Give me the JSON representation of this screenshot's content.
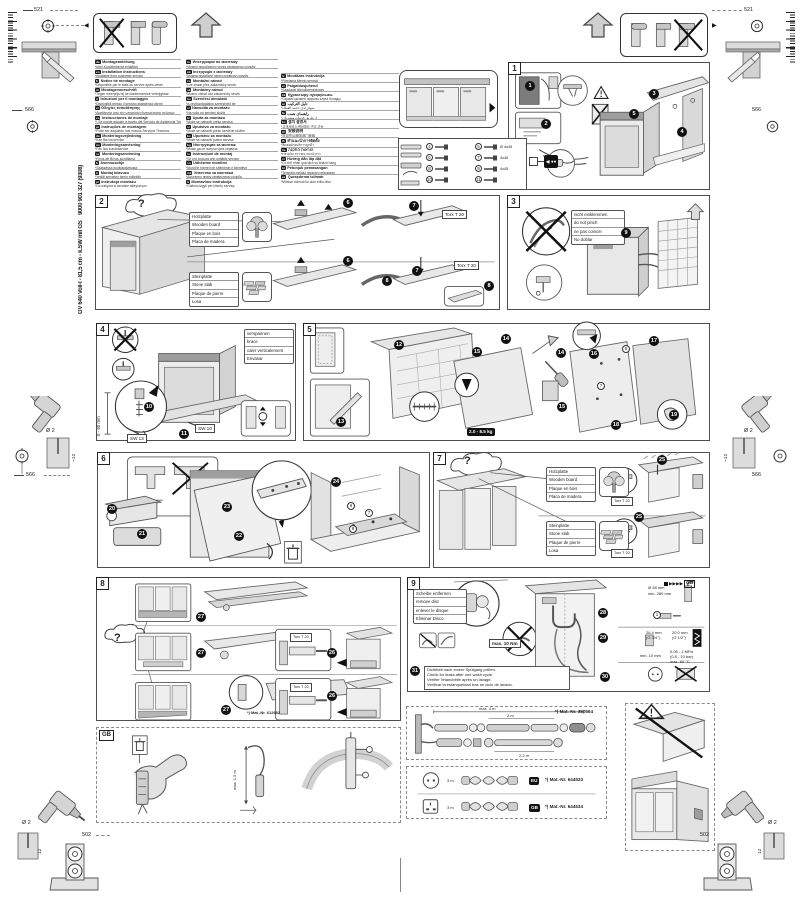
{
  "doc": {
    "model": "GV 640 Voll-I - 81,5 cm - k.SW mit GS",
    "order_no": "9000 901 327 (9308)"
  },
  "glyphs": {
    "question": "?",
    "tri_left": "◀",
    "tri_right": "▶",
    "fwd_arrows": "▶▶▶▶",
    "back_arrow": "◀"
  },
  "corner_dims": {
    "width_521": "521",
    "depth_566": "566",
    "offset_502": "502",
    "hole_dia": "Ø 2",
    "hole_depth": "12",
    "hole_depth_tilde": "~12"
  },
  "labels": {
    "wood": [
      "Holzplatte",
      "Wooden board",
      "Plaque en bois",
      "Placa de madera"
    ],
    "stone": [
      "Steinplatte",
      "Stone slab",
      "Plaque de pierre",
      "Losa"
    ],
    "torx": "Torx T 20"
  },
  "languages": {
    "col1": [
      {
        "code": "de",
        "title": "Montageanleitung",
        "note": "*über Kundendienst erhältlich"
      },
      {
        "code": "en",
        "title": "Installation instructions",
        "note": "*Available from customer service"
      },
      {
        "code": "fr",
        "title": "Notice de montage",
        "note": "*Disponible par le biais du service après-vente"
      },
      {
        "code": "nl",
        "title": "Montagevoorschrift",
        "note": "*Tegen meerprijs bij de klantenservice verkrijgbaar"
      },
      {
        "code": "it",
        "title": "Istruzioni per il montaggio",
        "note": "*Disponibili presso il servizio assistenza clienti"
      },
      {
        "code": "el",
        "title": "Οδηγίες τοποθέτησης",
        "note": "*Διατίθενται από την υπηρεσία εξυπηρέτησης πελατών"
      },
      {
        "code": "es",
        "title": "Instrucciones de montaje",
        "note": "*) Se puede adquirir a través del Servicio de Asistencia Técnica"
      },
      {
        "code": "pt",
        "title": "Instruções de montagem",
        "note": "*Pode ser adquirido nos nossos Serviços Técnicos"
      },
      {
        "code": "da",
        "title": "Monteringsvejledning",
        "note": "*Kan fås via service"
      },
      {
        "code": "no",
        "title": "Monteringsanvisning",
        "note": "*Fås hos kundeservice"
      },
      {
        "code": "sv",
        "title": "Monteringsanvisning",
        "note": "*Finns att få hos kundtjänst"
      },
      {
        "code": "fi",
        "title": "Asennusohje",
        "note": "*Saatavissa huoltopalvelusta"
      },
      {
        "code": "tr",
        "title": "Montaj kılavuzu",
        "note": "*Yetkili servisten temin edilebilir"
      },
      {
        "code": "pl",
        "title": "Instrukcja montażu",
        "note": "*Do nabycia w serwisie fabrycznym"
      }
    ],
    "col2": [
      {
        "code": "ru",
        "title": "Инструкция по монтажу",
        "note": "*Можно приобрести через сервисную службу"
      },
      {
        "code": "uk",
        "title": "Інструкція з монтажу",
        "note": "*Можна придбати через сервісну службу"
      },
      {
        "code": "cs",
        "title": "Montážní návod",
        "note": "*Lze získat přes zákaznický servis"
      },
      {
        "code": "sk",
        "title": "Montážny návod",
        "note": "*Možno získať cez zákaznícky servis"
      },
      {
        "code": "hu",
        "title": "Szerelési útmutató",
        "note": "*A vevőszolgálaton szerezhető be"
      },
      {
        "code": "sl",
        "title": "Navodila za montažo",
        "note": "*Na voljo pri servisni službi"
      },
      {
        "code": "hr",
        "title": "Uputa za montažu",
        "note": "*Može se nabaviti preko servisa"
      },
      {
        "code": "sr",
        "title": "Uputstvo za montažu",
        "note": "*Može se nabaviti preko servisne službe"
      },
      {
        "code": "bs",
        "title": "Uputstvo za montažu",
        "note": "*Može se nabaviti putem servisa"
      },
      {
        "code": "bg",
        "title": "Инструкция за монтаж",
        "note": "*Може да се получи чрез сервиза"
      },
      {
        "code": "ro",
        "title": "Instrucţiuni de montaj",
        "note": "*Se pot procura prin unităţile service"
      },
      {
        "code": "sq",
        "title": "Udhëzime montimi",
        "note": "*Mund të merren në shërbimin e klientëve"
      },
      {
        "code": "mk",
        "title": "Упатство за монтажа",
        "note": "*Достапно преку сервисната служба"
      },
      {
        "code": "lt",
        "title": "Montavimo instrukcija",
        "note": "*Galima įsigyti per klientų servisą"
      }
    ],
    "col3": [
      {
        "code": "lv",
        "title": "Montāžas instrukcija",
        "note": "*Pieejama klientu servisā"
      },
      {
        "code": "et",
        "title": "Paigaldusjuhend",
        "note": "*Saadaval klienditeeninduses"
      },
      {
        "code": "kk",
        "title": "Құрастыру нұсқаулығы",
        "note": "*Сервис қызметі арқылы алуға болады"
      },
      {
        "code": "ar",
        "title": "دليل التركيب",
        "note": "*متوفر لدى خدمة العملاء"
      },
      {
        "code": "fa",
        "title": "راهنمای نصب",
        "note": "*از طریق خدمات مشتریان"
      },
      {
        "code": "ko",
        "title": "설치 설명서",
        "note": "*고객서비스센터에서 구입 가능"
      },
      {
        "code": "zh",
        "title": "安装说明",
        "note": "*可向售后服务部门索取"
      },
      {
        "code": "th",
        "title": "คำแนะนำการติดตั้ง",
        "note": "*ติดต่อฝ่ายบริการลูกค้า"
      },
      {
        "code": "he",
        "title": "הוראות התקנה",
        "note": "*ניתן להשיג בשירות הלקוחות"
      },
      {
        "code": "vi",
        "title": "Hướng dẫn lắp đặt",
        "note": "*Có thể nhận qua dịch vụ khách hàng"
      },
      {
        "code": "id",
        "title": "Petunjuk pemasangan",
        "note": "*Tersedia melalui layanan pelanggan"
      },
      {
        "code": "az",
        "title": "Quraşdırma təlimatı",
        "note": "*Müştəri xidməti ilə əldə edilə bilər"
      }
    ]
  },
  "panel1": {
    "no": "1",
    "markers": [
      "1",
      "2",
      "3",
      "4",
      "5"
    ],
    "parts": [
      {
        "n": "4",
        "size": ""
      },
      {
        "n": "5",
        "size": "Ø 4x45"
      },
      {
        "n": "6",
        "size": ""
      },
      {
        "n": "7",
        "size": "4x45"
      },
      {
        "n": "8",
        "size": ""
      },
      {
        "n": "9",
        "size": "4x45"
      },
      {
        "n": "10",
        "size": ""
      },
      {
        "n": "11",
        "size": ""
      }
    ]
  },
  "panel2": {
    "no": "2",
    "markers": [
      "6",
      "7",
      "6",
      "7",
      "8",
      "8"
    ]
  },
  "panel3": {
    "no": "3",
    "pinch": [
      "nicht einklemmen",
      "do not pinch",
      "ne pas coincer",
      "No doblar"
    ],
    "markers": [
      "9"
    ]
  },
  "panel4": {
    "no": "4",
    "brace": [
      "verspannen",
      "brace",
      "caler verticalement",
      "Envasar"
    ],
    "range": "0 - 60 mm",
    "sw13": "SW 13",
    "sw10": "SW 10",
    "markers": [
      "10",
      "11"
    ]
  },
  "panel5": {
    "no": "5",
    "weight": "2.0 - 8.5 kg",
    "part_refs": [
      "5",
      "7"
    ],
    "markers": [
      "12",
      "13",
      "14",
      "15",
      "14",
      "15",
      "16",
      "17",
      "18",
      "19"
    ]
  },
  "panel6": {
    "no": "6",
    "markers": [
      "20",
      "21",
      "22",
      "23",
      "24"
    ],
    "part_refs": [
      "6",
      "7",
      "8"
    ]
  },
  "panel7": {
    "no": "7",
    "markers": [
      "25",
      "25"
    ]
  },
  "panel8": {
    "no": "8",
    "mat_no": "*) Mat.-Nr. 612682",
    "markers": [
      "27",
      "27",
      "26",
      "27",
      "26"
    ]
  },
  "panel9": {
    "no": "9",
    "disc": [
      "Scheibe entfernen",
      "remove disc",
      "enlever le disque",
      "Eliminar Disco"
    ],
    "torque": "max. 10 Nm",
    "gb_ref": "GB",
    "clamp_ref": "1",
    "leak": [
      "Dichtheit nach einem Spülgang prüfen.",
      "Check for leaks after one wash cycle.",
      "Vérifier l'étanchéité après un lavage.",
      "Verificar la estanqueidad tras un ciclo de lavado."
    ],
    "markers": [
      "28",
      "29",
      "30",
      "31"
    ],
    "specs": {
      "drain_dia": "Ø 38 mm",
      "drain_min": "min. 280 mm",
      "conn_34": "26.4 mm",
      "conn_34_inch": "(G 3/4\")",
      "conn_12": "20.0 mm",
      "conn_12_inch": "(G 1/2\")",
      "gap": "min. 10 mm",
      "pressure": "0.05 - 1 MPa",
      "pressure_bar": "(0.5 - 10 bar)",
      "temp": "max. 60 °C"
    }
  },
  "accessories": {
    "hose": {
      "mat_no": "*) Mat.-Nr. 350564",
      "total": "max. 4 m",
      "seg": "2 m",
      "seg2": "2.2 m"
    },
    "cords": [
      {
        "region": "EU",
        "length": "3 m",
        "mat_no": "*) Mat.-Nr. 644533"
      },
      {
        "region": "GB",
        "length": "3 m",
        "mat_no": "*) Mat.-Nr. 644534"
      }
    ]
  },
  "gb_section": {
    "tag": "GB",
    "cable_len": "max. 1.5 m"
  }
}
